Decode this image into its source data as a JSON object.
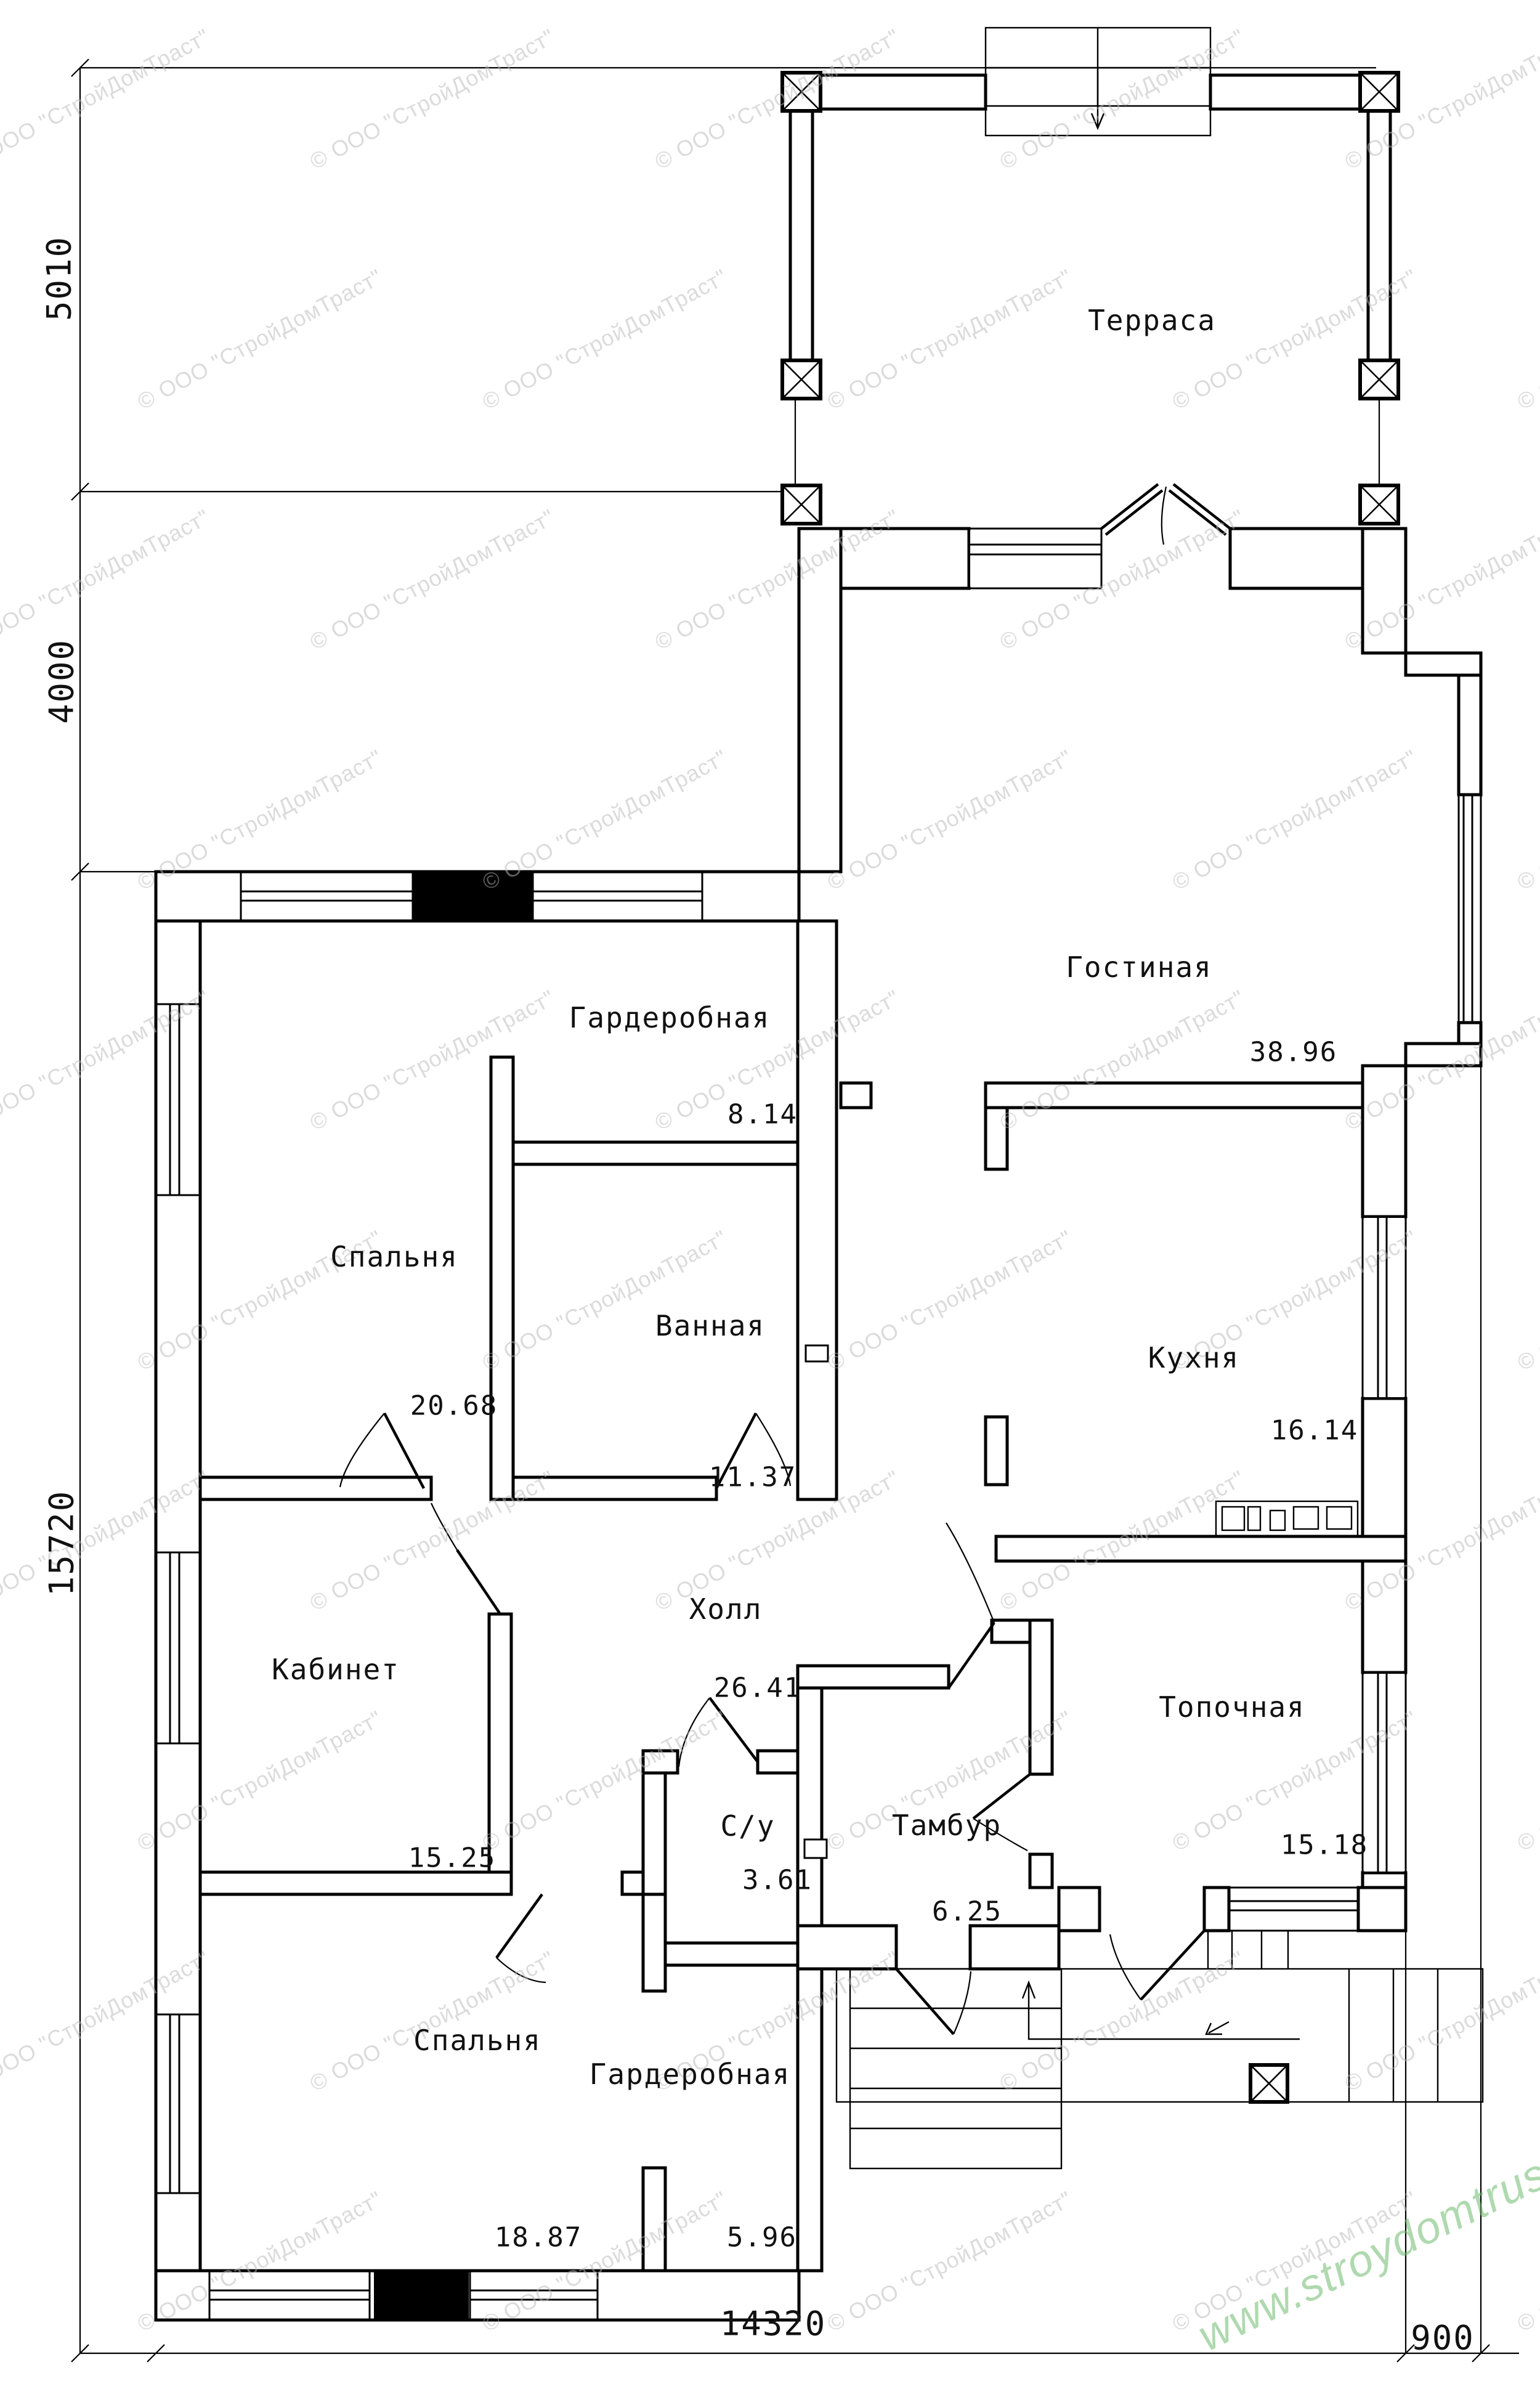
{
  "watermark": {
    "text": "© ООО \"СтройДомТраст\""
  },
  "site_url": "www.stroydomtrust.ru",
  "dimensions": {
    "terrace_depth": "5010",
    "side_offset": "4000",
    "house_depth": "15720",
    "house_width": "14320",
    "porch_offset": "900"
  },
  "rooms": [
    {
      "id": "terrace",
      "name": "Терраса",
      "area": ""
    },
    {
      "id": "living",
      "name": "Гостиная",
      "area": "38.96"
    },
    {
      "id": "wardrobe1",
      "name": "Гардеробная",
      "area": "8.14"
    },
    {
      "id": "bedroom1",
      "name": "Спальня",
      "area": "20.68"
    },
    {
      "id": "bath",
      "name": "Ванная",
      "area": "11.37"
    },
    {
      "id": "kitchen",
      "name": "Кухня",
      "area": "16.14"
    },
    {
      "id": "hall",
      "name": "Холл",
      "area": "26.41"
    },
    {
      "id": "office",
      "name": "Кабинет",
      "area": "15.25"
    },
    {
      "id": "wc",
      "name": "С/у",
      "area": "3.61"
    },
    {
      "id": "vestibule",
      "name": "Тамбур",
      "area": "6.25"
    },
    {
      "id": "boiler",
      "name": "Топочная",
      "area": "15.18"
    },
    {
      "id": "bedroom2",
      "name": "Спальня",
      "area": "18.87"
    },
    {
      "id": "wardrobe2",
      "name": "Гардеробная",
      "area": "5.96"
    }
  ]
}
